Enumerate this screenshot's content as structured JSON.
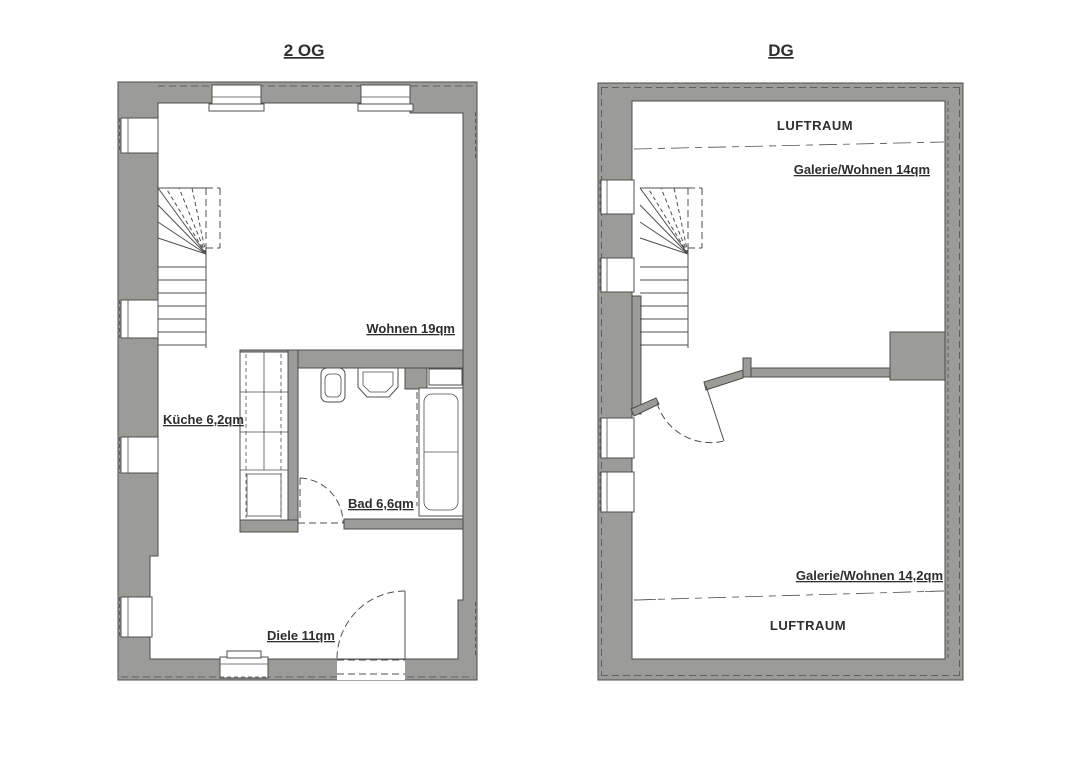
{
  "document": {
    "type": "floorplan-drawing",
    "background": "#ffffff"
  },
  "colors": {
    "wall": "#9b9c97",
    "outline": "#4c4c48",
    "line": "#4f4f4f",
    "text": "#2e2e2e",
    "background": "#ffffff"
  },
  "plans": {
    "og2": {
      "title": "2 OG",
      "labels": {
        "wohnen": "Wohnen 19qm",
        "kueche": "Küche 6,2qm",
        "bad": "Bad 6,6qm",
        "diele": "Diele 11qm"
      }
    },
    "dg": {
      "title": "DG",
      "labels": {
        "luftraum_top": "LUFTRAUM",
        "galerie_top": "Galerie/Wohnen 14qm",
        "galerie_bottom": "Galerie/Wohnen 14,2qm",
        "luftraum_bottom": "LUFTRAUM"
      }
    }
  }
}
